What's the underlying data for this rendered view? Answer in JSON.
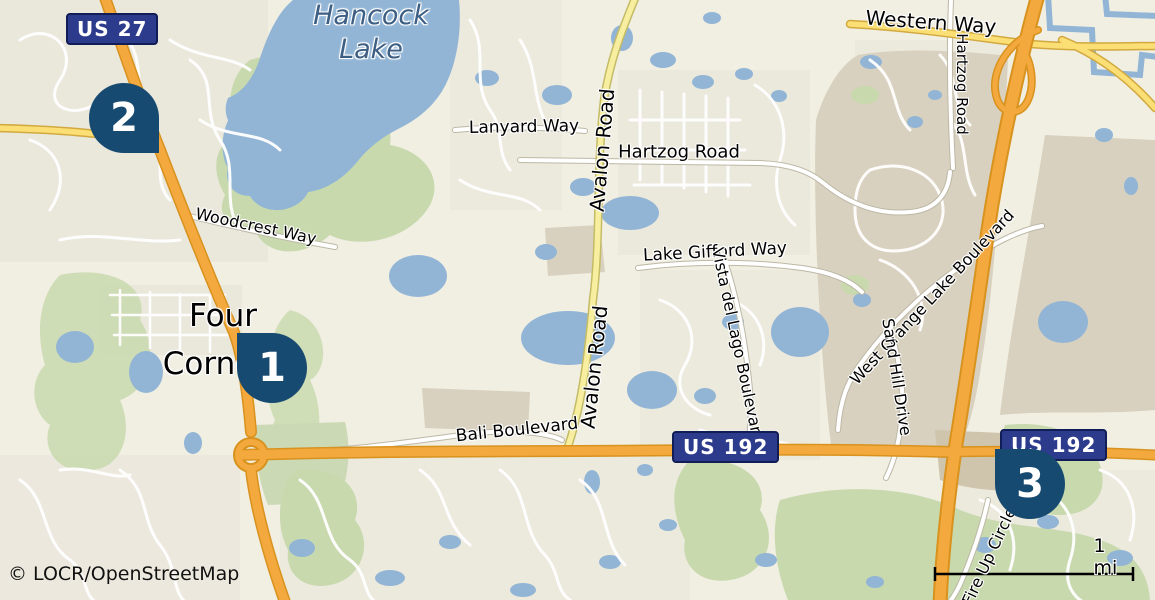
{
  "map": {
    "attribution": "© LOCR/OpenStreetMap",
    "scale_label": "1 mi",
    "place_labels": {
      "hancock_lake": "Hancock\nLake",
      "four_corners": "Four\nCorners"
    },
    "road_labels": {
      "western_way": "Western Way",
      "hartzog_road_top": "Hartzog Road",
      "hartzog_road_center": "Hartzog Road",
      "lanyard_way": "Lanyard Way",
      "avalon_road_upper": "Avalon Road",
      "avalon_road_lower": "Avalon Road",
      "lake_gifford_way": "Lake Gifford Way",
      "vista_del_lago": "Vista del Lago Boulevard",
      "west_orange_lake": "West Orange Lake Boulevard",
      "sand_hill_drive": "Sand Hill Drive",
      "woodcrest_way": "Woodcrest Way",
      "bali_boulevard": "Bali Boulevard",
      "fire_up_circle": "Fire Up Circle"
    },
    "shields": {
      "us27": "US 27",
      "us192_center": "US 192",
      "us192_right": "US 192"
    },
    "markers": [
      {
        "number": "1"
      },
      {
        "number": "2"
      },
      {
        "number": "3"
      }
    ],
    "colors": {
      "land": "#f1eee2",
      "water": "#92b5d6",
      "green": "#c8d9ae",
      "commercial": "#d9d1bf",
      "highway_fill": "#f3a93d",
      "highway_casing": "#d8921e",
      "secondary_fill": "#fbdf75",
      "shield_fill": "#2d3b8c",
      "marker_fill": "#164a70",
      "lake_label": "#3e5f84"
    }
  }
}
